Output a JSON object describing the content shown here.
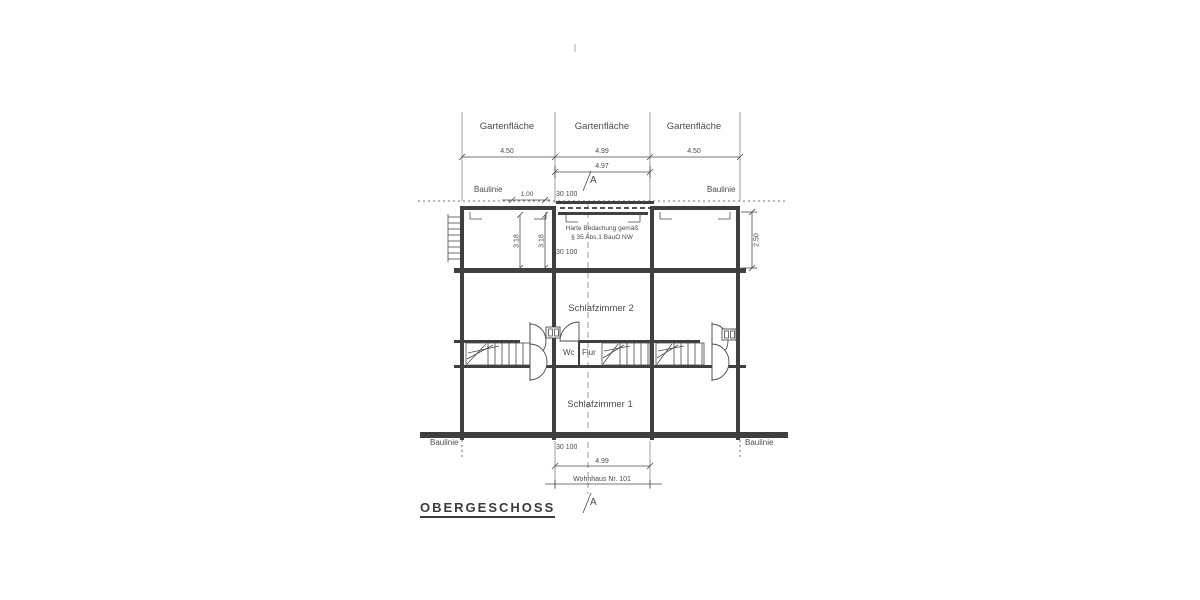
{
  "title": "OBERGESCHOSS",
  "section": {
    "a": "A"
  },
  "garden": {
    "g1": "Gartenfläche",
    "g2": "Gartenfläche",
    "g3": "Gartenfläche"
  },
  "baulinie": {
    "tl": "Baulinie",
    "tr": "Baulinie",
    "bl": "Baulinie",
    "br": "Baulinie"
  },
  "dims": {
    "top_left": "4.50",
    "top_middle": "4.99",
    "top_right": "4.50",
    "mid_width": "4.97",
    "small_left": "1.00",
    "pair_top": "30  100",
    "pair_mid": "30  100",
    "pair_bottom": "30  100",
    "room_height_a": "3.18",
    "room_height_b": "3.18",
    "room_height_right": "2.50",
    "bottom_width": "4.99"
  },
  "rooms": {
    "bedroom2": "Schlafzimmer 2",
    "bedroom1": "Schlafzimmer 1",
    "wc": "Wc",
    "hall": "Flur"
  },
  "note": {
    "line1": "Harte Bedachung gemäß",
    "line2": "§ 35 Abs.1 BauO NW"
  },
  "house_ref": "Wohnhaus Nr. 101",
  "colors": {
    "line": "#4a4a4a",
    "text": "#4c4c4c",
    "bg": "#ffffff"
  }
}
